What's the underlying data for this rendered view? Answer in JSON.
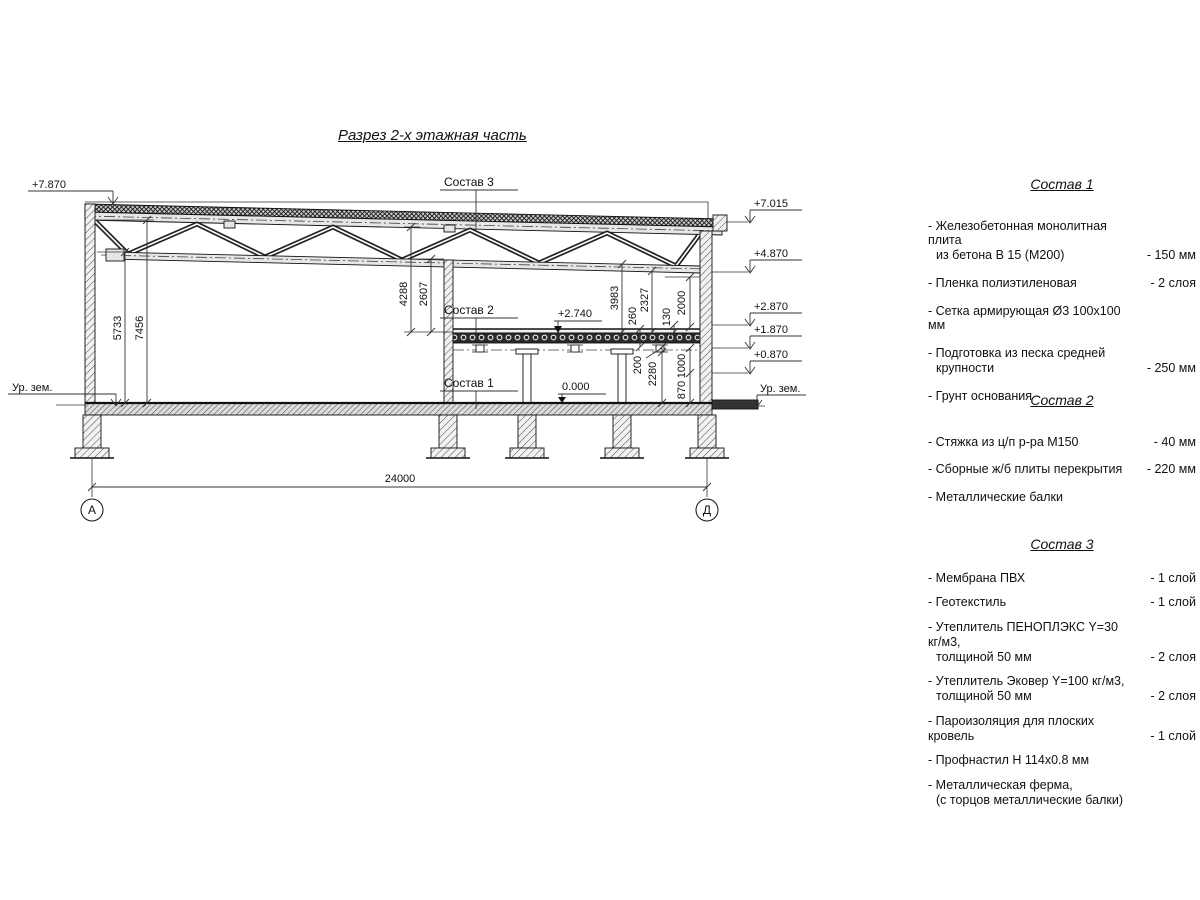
{
  "title": "Разрез 2-х этажная часть",
  "drawing": {
    "elevation_left_top": "+7.870",
    "ground_label_left": "Ур. зем.",
    "ground_label_right": "Ур. зем.",
    "elevation_right_1": "+7.015",
    "elevation_right_2": "+4.870",
    "elevation_right_3": "+2.870",
    "elevation_right_4": "+1.870",
    "elevation_right_5": "+0.870",
    "level_slab": "+2.740",
    "level_floor": "0.000",
    "callout_sostav3": "Состав 3",
    "callout_sostav2": "Состав 2",
    "callout_sostav1": "Состав 1",
    "dim_5733": "5733",
    "dim_7456": "7456",
    "dim_4288": "4288",
    "dim_2607": "2607",
    "dim_3983": "3983",
    "dim_2327": "2327",
    "dim_2000": "2000",
    "dim_260": "260",
    "dim_130": "130",
    "dim_200": "200",
    "dim_2280": "2280",
    "dim_1000": "1000",
    "dim_870": "870",
    "dim_span": "24000",
    "axis_left": "А",
    "axis_right": "Д"
  },
  "panels": [
    {
      "title": "Состав 1",
      "items": [
        {
          "line1": "- Железобетонная  монолитная плита",
          "line2": "из бетона В 15 (М200)",
          "value": "- 150 мм"
        },
        {
          "line1": "- Пленка полиэтиленовая",
          "value": "- 2 слоя"
        },
        {
          "line1": "- Сетка армирующая Ø3 100x100 мм",
          "value": ""
        },
        {
          "line1": "- Подготовка из песка средней",
          "line2": "крупности",
          "value": "- 250 мм"
        },
        {
          "line1": "- Грунт основания",
          "value": ""
        }
      ]
    },
    {
      "title": "Состав 2",
      "items": [
        {
          "line1": "- Стяжка из ц/п р-ра М150",
          "value": "- 40 мм"
        },
        {
          "line1": "- Сборные ж/б плиты перекрытия",
          "value": "- 220 мм"
        },
        {
          "line1": "- Металлические балки",
          "value": ""
        }
      ]
    },
    {
      "title": "Состав 3",
      "items": [
        {
          "line1": "- Мембрана ПВХ",
          "value": "- 1 слой"
        },
        {
          "line1": "- Геотекстиль",
          "value": "- 1 слой"
        },
        {
          "line1": "- Утеплитель ПЕНОПЛЭКС Y=30 кг/м3,",
          "line2": "толщиной 50 мм",
          "value": "- 2 слоя"
        },
        {
          "line1": "- Утеплитель Эковер Y=100 кг/м3,",
          "line2": "толщиной 50 мм",
          "value": "- 2 слоя"
        },
        {
          "line1": "- Пароизоляция для плоских кровель",
          "value": "- 1 слой"
        },
        {
          "line1": "- Профнастил Н 114х0.8 мм",
          "value": ""
        },
        {
          "line1": "- Металлическая ферма,",
          "line2": "(с торцов металлические балки)",
          "value": ""
        }
      ]
    }
  ]
}
